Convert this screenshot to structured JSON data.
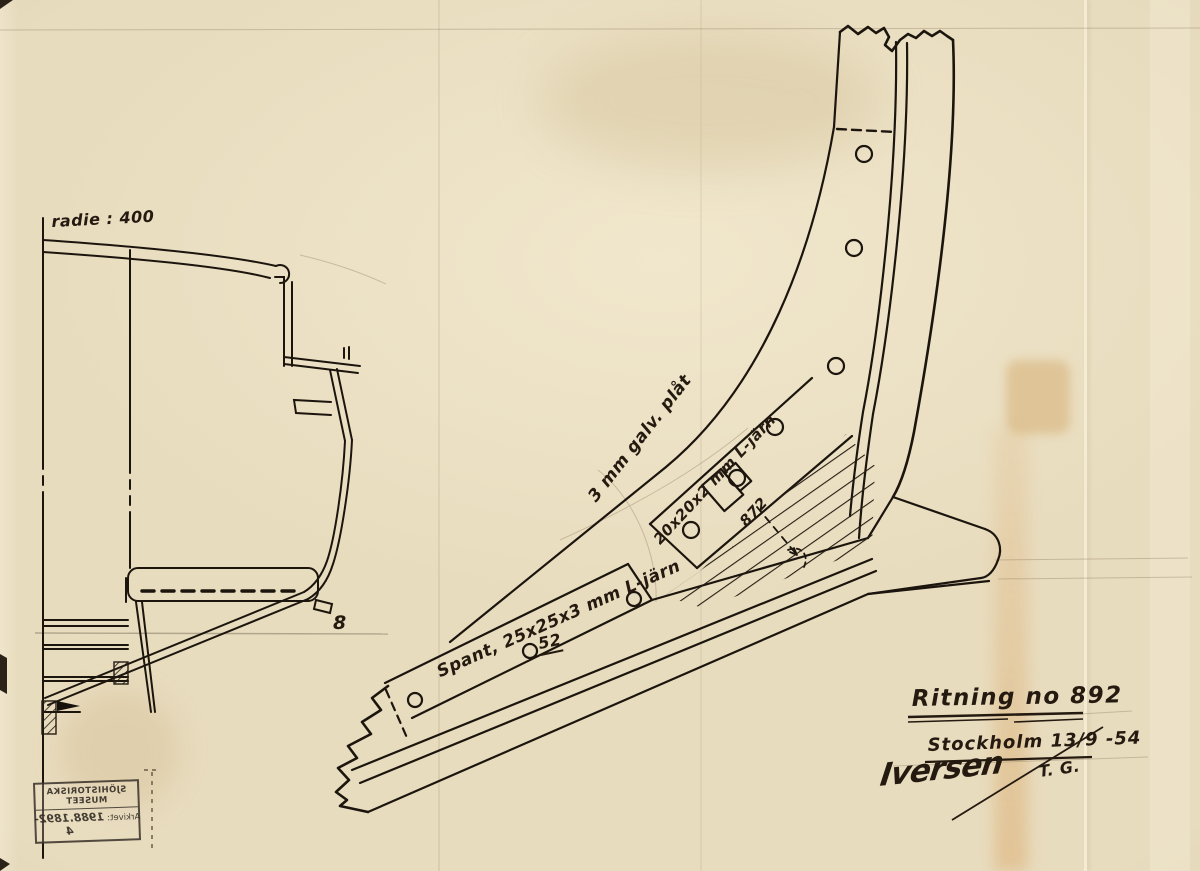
{
  "annotations": {
    "radius": "radie : 400",
    "plate": "3 mm galv. plåt",
    "angle_iron": "20x20x2 mm L-järn",
    "spant": "Spant, 25x25x3 mm L-järn",
    "rivet_mark": "52",
    "dim_mark": "872",
    "baseline_mark": "8"
  },
  "title_block": {
    "drawing_no": "Ritning no 892",
    "place_date": "Stockholm 13/9 -54",
    "signature": "Iversen",
    "initials": "T. G."
  },
  "stamp": {
    "museum": "SJÖHISTORISKA MUSEET",
    "archive_label": "Arkivet:",
    "archive_no": "1988.1892-4"
  },
  "colors": {
    "paper": "#e8dcbe",
    "ink": "#1c150e",
    "pencil": "#8d7b5f"
  }
}
